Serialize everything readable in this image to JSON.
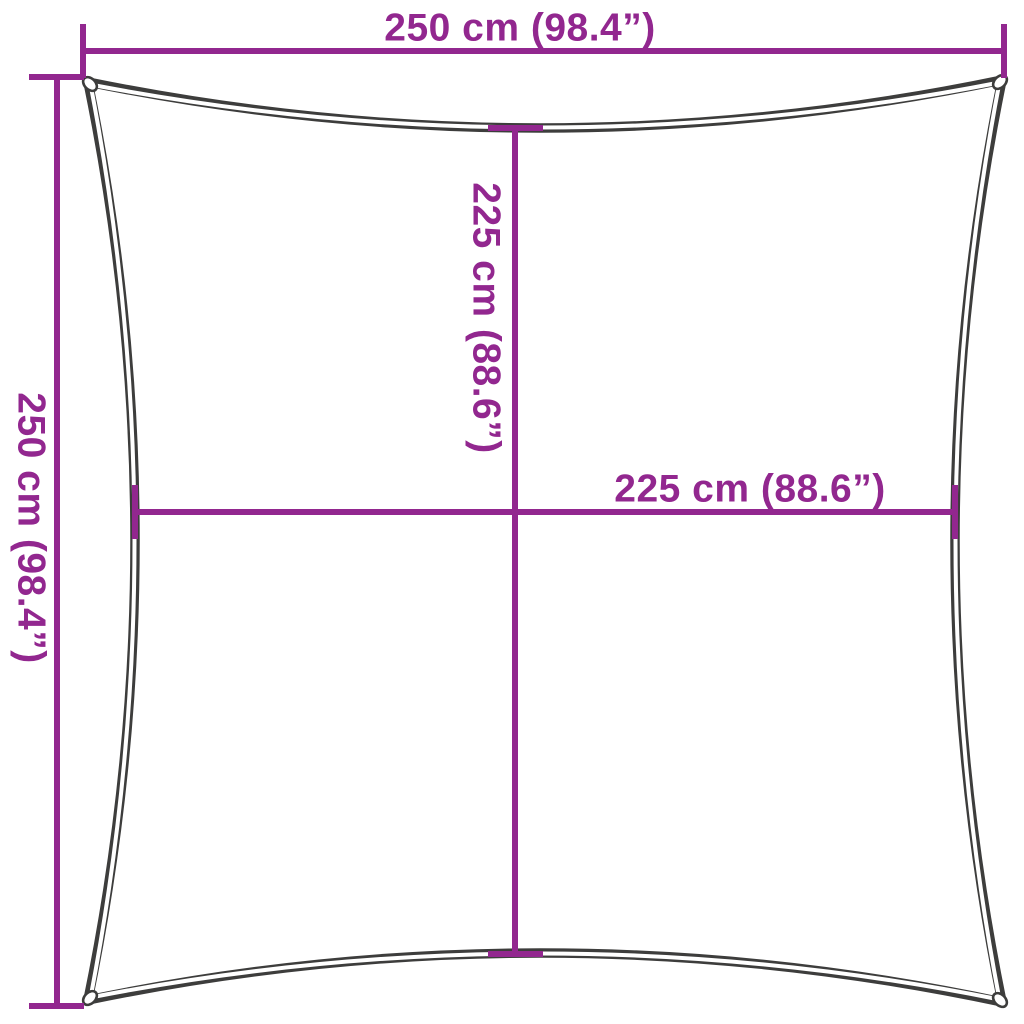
{
  "diagram": {
    "title": "square shade sail dimension diagram",
    "colors": {
      "dimension_line": "#92278F",
      "sail_outline": "#3D3D3C",
      "background": "#FFFFFF"
    },
    "labels": {
      "top_width": "250 cm (98.4”)",
      "left_height": "250 cm (98.4”)",
      "inner_height": "225 cm (88.6”)",
      "inner_width": "225 cm (88.6”)"
    }
  }
}
